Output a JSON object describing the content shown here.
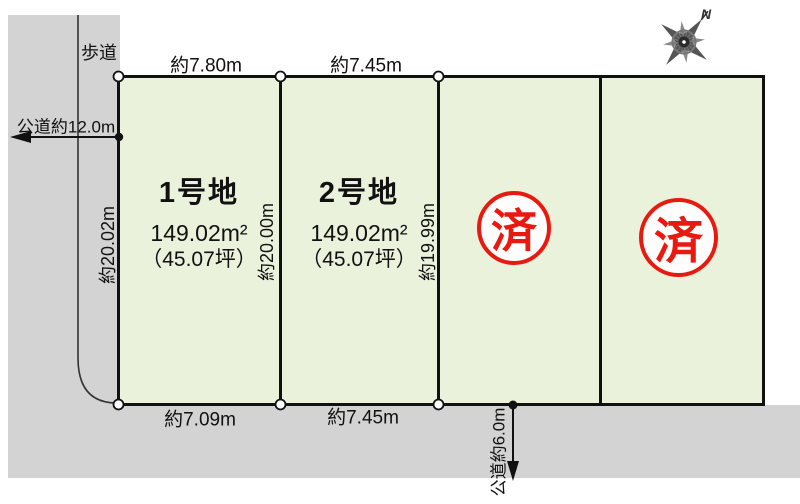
{
  "compass": {
    "north_label": "N"
  },
  "roads": {
    "sidewalk_label": "歩道",
    "west_road_label": "公道約12.0m",
    "south_road_label": "公道約6.0m"
  },
  "plots": [
    {
      "id": "1",
      "name": "1号地",
      "area": "149.02m²",
      "area_tsubo": "（45.07坪）",
      "status": "available",
      "dim_top": "約7.80m",
      "dim_bottom": "約7.09m",
      "dim_left": "約20.02m",
      "dim_right": "約20.00m"
    },
    {
      "id": "2",
      "name": "2号地",
      "area": "149.02m²",
      "area_tsubo": "（45.07坪）",
      "status": "available",
      "dim_top": "約7.45m",
      "dim_bottom": "約7.45m",
      "dim_right": "約19.99m"
    },
    {
      "id": "3",
      "status": "sold",
      "stamp": "済"
    },
    {
      "id": "4",
      "status": "sold",
      "stamp": "済"
    }
  ],
  "colors": {
    "plot_fill": "#eaf2dc",
    "road_fill": "#d3d3d3",
    "line": "#111111",
    "stamp_red": "#e8190f"
  }
}
